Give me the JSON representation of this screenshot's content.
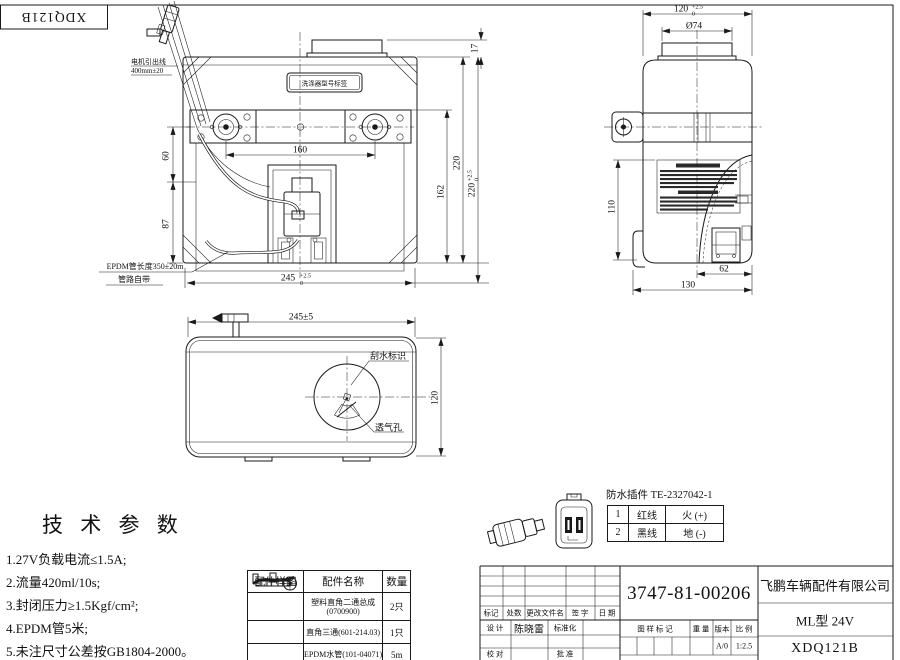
{
  "frame": {
    "corner_code": "XDQ121B"
  },
  "tol": {
    "up": "+2.5",
    "dn": "0"
  },
  "front_view": {
    "model_label": "洗涤器型号标签",
    "wire_note_line1": "电机引出线",
    "wire_note_line2": "400mm±20",
    "hose_note_line1": "EPDM管长度350±20m",
    "hose_note_line2": "管路自带",
    "dim_60": "60",
    "dim_87": "87",
    "dim_160": "160",
    "dim_162": "162",
    "dim_220": "220",
    "dim_220_tol_main": "220",
    "dim_245_main": "245",
    "dim_17": "17"
  },
  "side_view": {
    "dim_120_main": "120",
    "dim_cap": "Ø74",
    "dim_110": "110",
    "dim_62": "62",
    "dim_130": "130"
  },
  "top_view": {
    "dim_245": "245±5",
    "dim_120": "120",
    "label_wiper": "刮水标识",
    "label_vent": "透气孔"
  },
  "tech_params": {
    "title": "技 术 参 数",
    "items": [
      "1.27V负载电流≤1.5A;",
      "2.流量420ml/10s;",
      "3.封闭压力≥1.5Kgf/cm²;",
      "4.EPDM管5米;",
      "5.未注尺寸公差按GB1804-2000。"
    ]
  },
  "parts_table": {
    "headers": [
      "配件样图",
      "配件名称",
      "数量"
    ],
    "rows": [
      {
        "icon": "elbow-two-way-fitting",
        "name_line1": "塑料直角二通总成",
        "name_line2": "(0700900)",
        "qty": "2只"
      },
      {
        "icon": "right-angle-tee-fitting",
        "name_line1": "直角三通(601-214.03)",
        "name_line2": "",
        "qty": "1只"
      },
      {
        "icon": "epdm-hose",
        "name_line1": "EPDM水管(101-04071)",
        "name_line2": "",
        "qty": "5m"
      }
    ]
  },
  "connector": {
    "title": "防水插件 TE-2327042-1",
    "pins": [
      {
        "no": "1",
        "wire": "红线",
        "func": "火 (+)"
      },
      {
        "no": "2",
        "wire": "黑线",
        "func": "地 (-)"
      }
    ]
  },
  "title_block": {
    "part_number": "3747-81-00206",
    "company": "飞鹏车辆配件有限公司",
    "model": "ML型 24V",
    "drawing_no": "XDQ121B",
    "rev_headers": [
      "标记",
      "处数",
      "更改文件名",
      "签 字",
      "日 期"
    ],
    "design_label": "设 计",
    "designer": "陈晓雷",
    "standard_label": "标准化",
    "check_label": "校 对",
    "approve_label": "批 准",
    "stamp_label": "图 样 标 记",
    "weight_label": "重 量",
    "version_label": "版本",
    "scale_label": "比 例",
    "version_value": "A/0",
    "scale_value": "1:2.5"
  }
}
